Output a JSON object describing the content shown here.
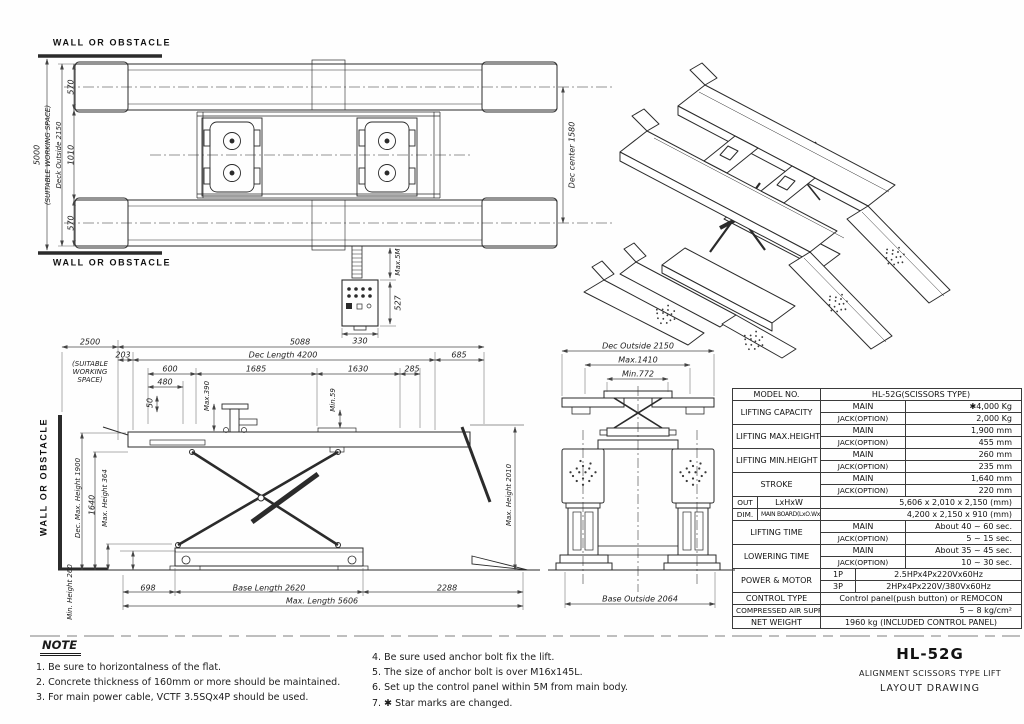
{
  "accent_colors": {
    "ink": "#2b2b2b",
    "dim_line": "#4a4a4a",
    "paper": "#fefefe"
  },
  "plan_view": {
    "wall_top": "WALL OR OBSTACLE",
    "wall_bottom": "WALL OR OBSTACLE",
    "working_space": "5000",
    "working_space_note": "(SUITABLE WORKING SPACE)",
    "deck_outside": "Deck Outside 2150",
    "deck_width_top": "570",
    "deck_gap": "1010",
    "deck_width_bottom": "570",
    "dec_center": "Dec center 1580",
    "cable_length": "Max.5M",
    "panel_height": "527",
    "panel_width": "330"
  },
  "side_view": {
    "wall": "WALL OR OBSTACLE",
    "working_space": "2500",
    "working_space_note": "(SUITABLE\nWORKING\nSPACE)",
    "overall": "5088",
    "d203": "203",
    "dec_length": "Dec Length 4200",
    "d685": "685",
    "d600": "600",
    "d1685": "1685",
    "d1630": "1630",
    "d285": "285",
    "d480": "480",
    "d50": "50",
    "max390": "Max.390",
    "min59": "Min.59",
    "dec_max_height": "Dec. Max. Height 1900",
    "d1640": "1640",
    "max_height364": "Max. Height 364",
    "min_height260": "Min. Height 260",
    "d698": "698",
    "base_length": "Base Length 2620",
    "d2288": "2288",
    "max_length": "Max. Length 5606",
    "max_height2010": "Max. Height 2010"
  },
  "front_view": {
    "dec_outside": "Dec Outside 2150",
    "max1410": "Max.1410",
    "min772": "Min.772",
    "base_outside": "Base Outside 2064"
  },
  "spec": {
    "model_label": "MODEL   NO.",
    "model_value": "HL-52G(SCISSORS TYPE)",
    "groups": [
      {
        "label": "LIFTING  CAPACITY",
        "r1": [
          "MAIN",
          "✱4,000  Kg"
        ],
        "r2": [
          "JACK(OPTION)",
          "2,000  Kg"
        ]
      },
      {
        "label": "LIFTING  MAX.HEIGHT",
        "r1": [
          "MAIN",
          "1,900  mm"
        ],
        "r2": [
          "JACK(OPTION)",
          "455  mm"
        ]
      },
      {
        "label": "LIFTING  MIN.HEIGHT",
        "r1": [
          "MAIN",
          "260  mm"
        ],
        "r2": [
          "JACK(OPTION)",
          "235  mm"
        ]
      },
      {
        "label": "STROKE",
        "r1": [
          "MAIN",
          "1,640  mm"
        ],
        "r2": [
          "JACK(OPTION)",
          "220  mm"
        ]
      }
    ],
    "outdim": {
      "c1a": "OUT",
      "c1b": "DIM.",
      "r1": [
        "LxHxW",
        "5,606 x 2,010 x 2,150 (mm)"
      ],
      "r2": [
        "MAIN BOARD(LxO.WxI.W)",
        "4,200 x 2,150 x 910 (mm)"
      ]
    },
    "times": [
      {
        "label": "LIFTING  TIME",
        "r1": [
          "MAIN",
          "About 40 ~ 60 sec."
        ],
        "r2": [
          "JACK(OPTION)",
          "5 ~ 15 sec."
        ]
      },
      {
        "label": "LOWERING  TIME",
        "r1": [
          "MAIN",
          "About 35 ~ 45 sec."
        ],
        "r2": [
          "JACK(OPTION)",
          "10 ~ 30 sec."
        ]
      }
    ],
    "power": {
      "label": "POWER  &  MOTOR",
      "r1": [
        "1P",
        "2.5HPx4Px220Vx60Hz"
      ],
      "r2": [
        "3P",
        "2HPx4Px220V/380Vx60Hz"
      ]
    },
    "control": {
      "label": "CONTROL  TYPE",
      "value": "Control panel(push button) or REMOCON"
    },
    "air": {
      "label": "COMPRESSED AIR SUPPLY",
      "value": "5 ~ 8 kg/cm²"
    },
    "weight": {
      "label": "NET  WEIGHT",
      "value": "1960 kg (INCLUDED CONTROL PANEL)"
    }
  },
  "notes": {
    "heading": "NOTE",
    "left": [
      "1.  Be  sure  to  horizontalness  of  the  flat.",
      "2.  Concrete  thickness  of  160mm  or  more  should  be  maintained.",
      "3.  For  main  power  cable,  VCTF  3.5SQx4P  should  be  used."
    ],
    "right": [
      "4.  Be  sure  used  anchor  bolt  fix  the  lift.",
      "5.  The  size  of  anchor  bolt  is  over  M16x145L.",
      "6.  Set  up  the  control  panel  within  5M  from  main  body.",
      "7.  ✱ Star  marks  are  changed."
    ]
  },
  "title_block": {
    "model": "HL-52G",
    "line1": "ALIGNMENT  SCISSORS  TYPE  LIFT",
    "line2": "LAYOUT  DRAWING"
  }
}
